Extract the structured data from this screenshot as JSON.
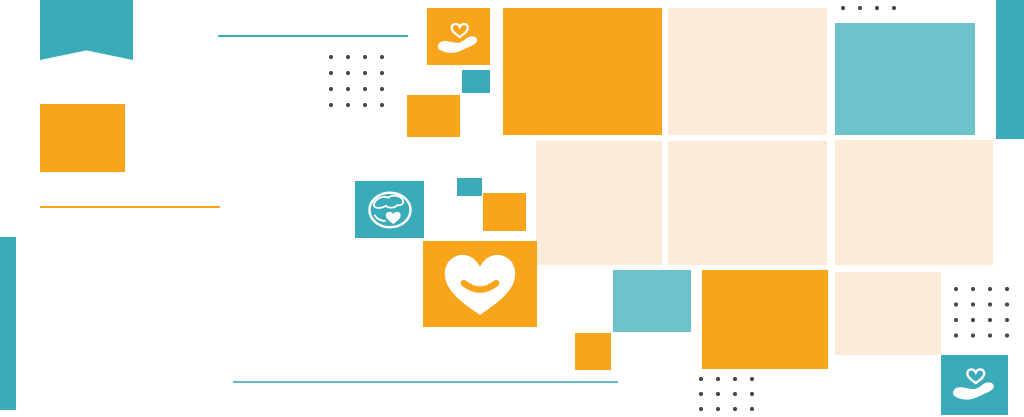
{
  "banner": {
    "description": "decorative charity-themed banner, no text",
    "background": "#FFFFFF"
  },
  "palette": {
    "orange": "#F9A51B",
    "teal": "#3AABB9",
    "teal-light": "#6FC1CC",
    "cream": "#FCEBD8",
    "dot": "#4A4A4A",
    "line-light": "#62B8CC",
    "white": "#FFFFFF"
  },
  "icons": [
    {
      "name": "hand-holding-heart-icon",
      "tile": "orange",
      "position": "top-center"
    },
    {
      "name": "globe-heart-icon",
      "tile": "teal",
      "position": "middle-left"
    },
    {
      "name": "smiling-heart-icon",
      "tile": "orange",
      "position": "middle-center"
    },
    {
      "name": "hand-holding-heart-icon",
      "tile": "teal",
      "position": "bottom-right"
    }
  ]
}
